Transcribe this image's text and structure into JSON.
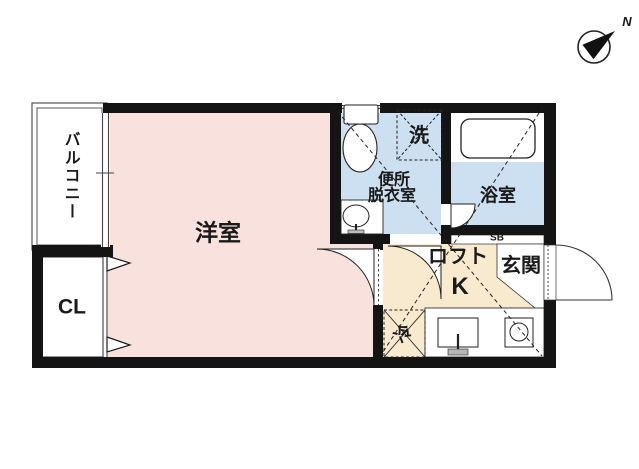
{
  "compass": {
    "north": "N"
  },
  "rooms": {
    "balcony": "バルコニー",
    "western_room": "洋室",
    "closet": "CL",
    "toilet_dressing_line1": "便所",
    "toilet_dressing_line2": "脱衣室",
    "washer": "洗",
    "bathroom": "浴室",
    "shoebox": "SB",
    "loft": "ロフト",
    "kitchen": "K",
    "entrance": "玄関",
    "refrigerator": "冷"
  },
  "colors": {
    "room_pink": "#f9e2dd",
    "wet_blue": "#cde0f1",
    "kitchen_beige": "#f7eacf",
    "wall": "#141414",
    "line": "#2a2a2a",
    "background": "#ffffff"
  }
}
